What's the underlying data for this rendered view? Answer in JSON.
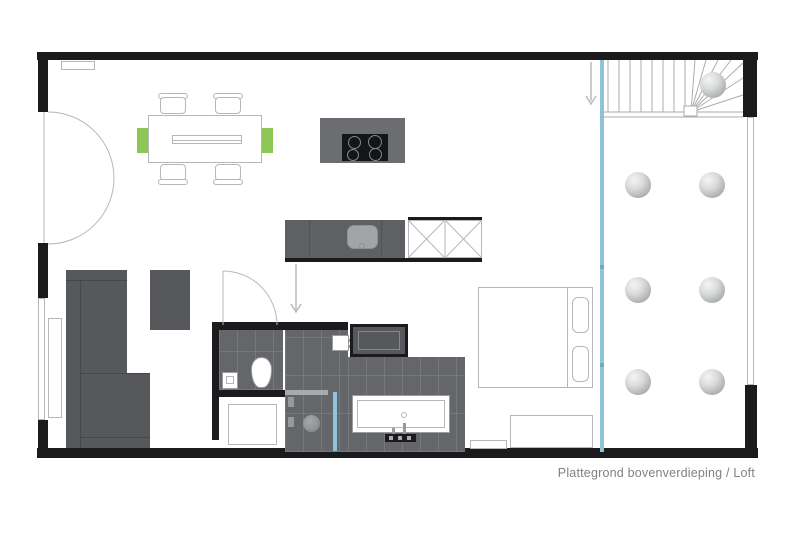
{
  "plan": {
    "caption": "Plattegrond bovenverdieping / Loft",
    "colors": {
      "wall": "#1b1b1d",
      "furniture": "#57585b",
      "furniture_light": "#6b6d70",
      "counter": "#5e6063",
      "tile": "#64666a",
      "tile_joint": "#76787c",
      "outline": "#b5b7b9",
      "outline_dark": "#9a9c9f",
      "green": "#8dc653",
      "blue": "#8fc3da",
      "text": "#7f8184",
      "sink": "#a2a4a7",
      "cooktop": "#141517"
    }
  }
}
